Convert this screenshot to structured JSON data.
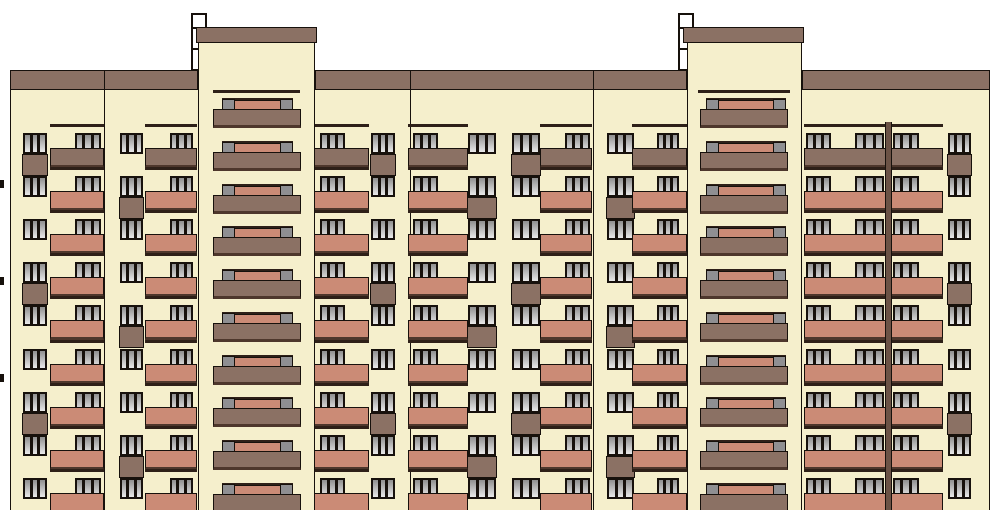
{
  "drawing": {
    "kind": "building-facade-elevation",
    "description": "Front elevation of a nine-storey panel apartment building with two raised stair towers",
    "canvas": {
      "width": 994,
      "height": 510
    }
  },
  "palette": {
    "background": "#FFFFFF",
    "wall": "#F5EFCC",
    "brown": "#8B7164",
    "salmon": "#CB8B76",
    "dark_edge": "#4E372C",
    "outline": "#17110C",
    "rail": "#2E2018",
    "pane_top": "#8F8F8F",
    "pane_bottom": "#E9E9E9",
    "post_gray": "#8F8F92",
    "strip": "#6B5245",
    "chimney_white": "#FFFFFF"
  },
  "grid": {
    "floor_tops": [
      133,
      176,
      219,
      262,
      305,
      349,
      392,
      435,
      478
    ],
    "tower_floor_tops": [
      98,
      141,
      184,
      226,
      269,
      312,
      355,
      397,
      440,
      483
    ],
    "window_height": 21,
    "panel_height": 22,
    "rail_offset": 9,
    "front_offset": 15,
    "front_height": 20,
    "front_colors_by_row": [
      "brown",
      "salmon",
      "salmon",
      "salmon",
      "salmon",
      "salmon",
      "salmon",
      "salmon",
      "salmon"
    ]
  },
  "facade": {
    "wall": {
      "x": 10,
      "y": 90,
      "w": 980,
      "h": 420
    },
    "roof_band": {
      "y": 70,
      "h": 20,
      "segments": [
        [
          10,
          188
        ],
        [
          315,
          372
        ],
        [
          802,
          188
        ]
      ]
    },
    "section_joints": [
      104,
      410,
      593
    ],
    "downpipe_strip": {
      "x": 885,
      "y": 122,
      "w": 7,
      "h": 388
    },
    "level_marks": {
      "x": 0,
      "w": 4,
      "h": 8,
      "ys": [
        180,
        277,
        374
      ]
    }
  },
  "chimneys": [
    {
      "x": 191,
      "y": 13,
      "w": 16,
      "h": 58,
      "joints": [
        27,
        48
      ]
    },
    {
      "x": 678,
      "y": 13,
      "w": 16,
      "h": 58,
      "joints": [
        27,
        48
      ]
    }
  ],
  "towers": [
    {
      "cap": {
        "x": 196,
        "y": 27,
        "w": 121,
        "h": 16
      },
      "wall": {
        "x": 198,
        "y": 43,
        "w": 117
      },
      "cornice": {
        "x": 213,
        "y": 90,
        "w": 87
      },
      "loggia": {
        "front_x": 213,
        "front_w": 88,
        "bar_x": 222,
        "bar_w": 71,
        "post_w": 13
      }
    },
    {
      "cap": {
        "x": 683,
        "y": 27,
        "w": 121,
        "h": 16
      },
      "wall": {
        "x": 687,
        "y": 43,
        "w": 115
      },
      "cornice": {
        "x": 698,
        "y": 90,
        "w": 92
      },
      "loggia": {
        "front_x": 700,
        "front_w": 88,
        "bar_x": 706,
        "bar_w": 80,
        "post_w": 13
      }
    }
  ],
  "window_columns": [
    {
      "x": 23,
      "w": 24,
      "panels": [
        0,
        3,
        6
      ]
    },
    {
      "x": 120,
      "w": 23,
      "panels": [
        1,
        4,
        7
      ]
    },
    {
      "x": 371,
      "w": 24,
      "panels": [
        0,
        3,
        6
      ]
    },
    {
      "x": 468,
      "w": 28,
      "panels": [
        1,
        4,
        7
      ]
    },
    {
      "x": 512,
      "w": 28,
      "panels": [
        0,
        3,
        6
      ]
    },
    {
      "x": 607,
      "w": 27,
      "panels": [
        1,
        4,
        7
      ]
    },
    {
      "x": 948,
      "w": 23,
      "panels": [
        0,
        3,
        6
      ]
    }
  ],
  "balcony_columns": [
    {
      "front_x": 50,
      "front_w": 54,
      "windows": [
        {
          "x": 75,
          "w": 26
        }
      ]
    },
    {
      "front_x": 145,
      "front_w": 52,
      "windows": [
        {
          "x": 170,
          "w": 23
        }
      ]
    },
    {
      "front_x": 313,
      "front_w": 56,
      "windows": [
        {
          "x": 320,
          "w": 25
        }
      ]
    },
    {
      "front_x": 408,
      "front_w": 60,
      "windows": [
        {
          "x": 413,
          "w": 25
        }
      ]
    },
    {
      "front_x": 540,
      "front_w": 52,
      "windows": [
        {
          "x": 565,
          "w": 25
        }
      ]
    },
    {
      "front_x": 632,
      "front_w": 55,
      "windows": [
        {
          "x": 657,
          "w": 22
        }
      ]
    },
    {
      "front_x": 804,
      "front_w": 82,
      "windows": [
        {
          "x": 806,
          "w": 25
        },
        {
          "x": 855,
          "w": 29
        }
      ]
    },
    {
      "front_x": 890,
      "front_w": 53,
      "windows": [
        {
          "x": 893,
          "w": 26
        }
      ]
    }
  ]
}
